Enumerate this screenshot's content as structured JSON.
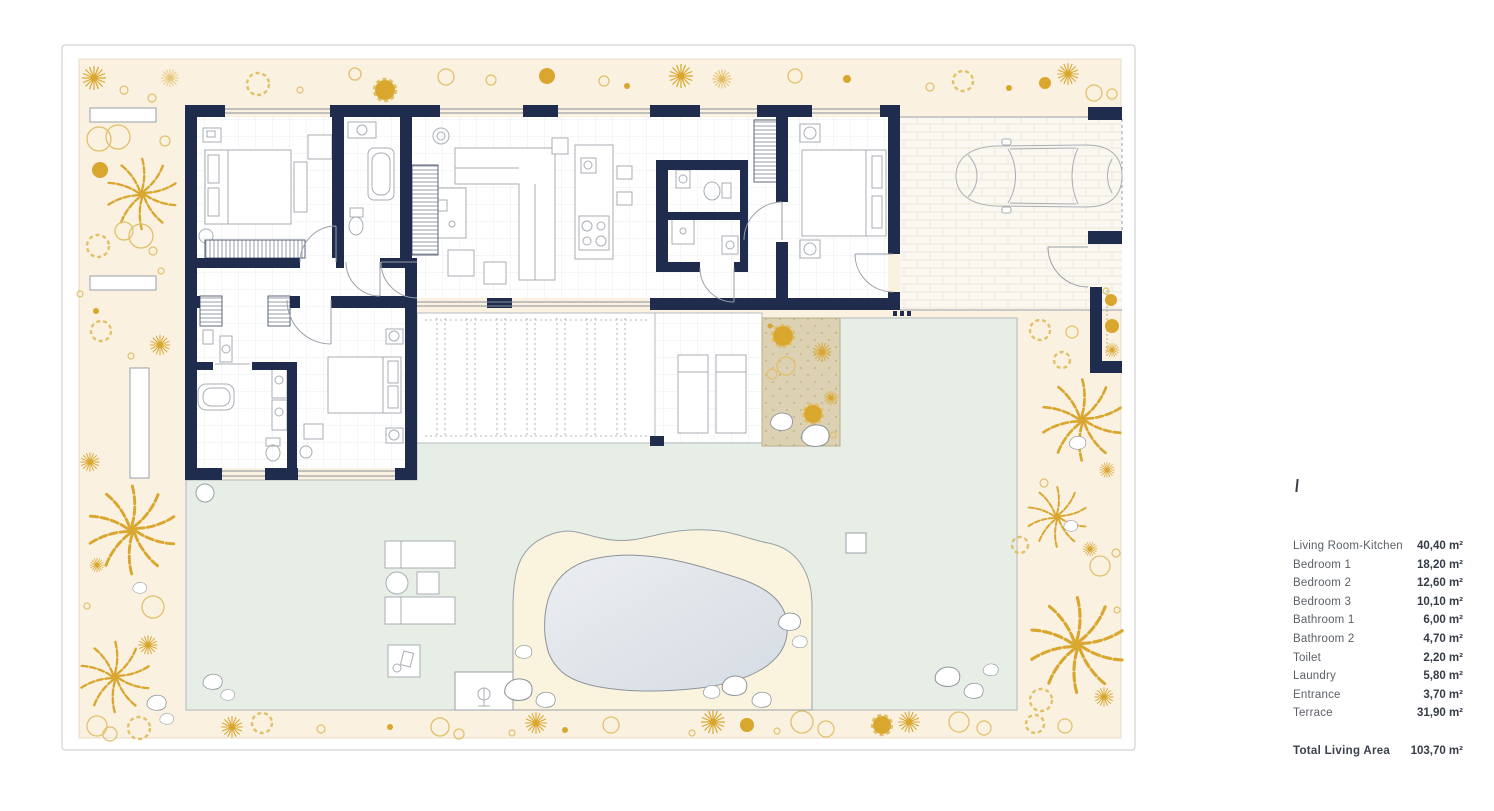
{
  "palette": {
    "navy": "#1f2c4d",
    "cream": "#faf1e1",
    "gold": "#d9a62e",
    "gold_light": "#e2c06a",
    "lawn": "#e7eee5",
    "sand": "#ddd1b4",
    "pool_sand": "#faf3dd",
    "pool_water": "#d5dce3",
    "driveway": "#fbf8f1"
  },
  "legend": {
    "items": [
      {
        "label": "Living Room-Kitchen",
        "value": "40,40 m²"
      },
      {
        "label": "Bedroom 1",
        "value": "18,20 m²"
      },
      {
        "label": "Bedroom 2",
        "value": "12,60 m²"
      },
      {
        "label": "Bedroom 3",
        "value": "10,10 m²"
      },
      {
        "label": "Bathroom 1",
        "value": "6,00 m²"
      },
      {
        "label": "Bathroom 2",
        "value": "4,70 m²"
      },
      {
        "label": "Toilet",
        "value": "2,20 m²"
      },
      {
        "label": "Laundry",
        "value": "5,80 m²"
      },
      {
        "label": "Entrance",
        "value": "3,70 m²"
      },
      {
        "label": "Terrace",
        "value": "31,90 m²"
      }
    ],
    "total": {
      "label": "Total Living Area",
      "value": "103,70 m²"
    }
  }
}
